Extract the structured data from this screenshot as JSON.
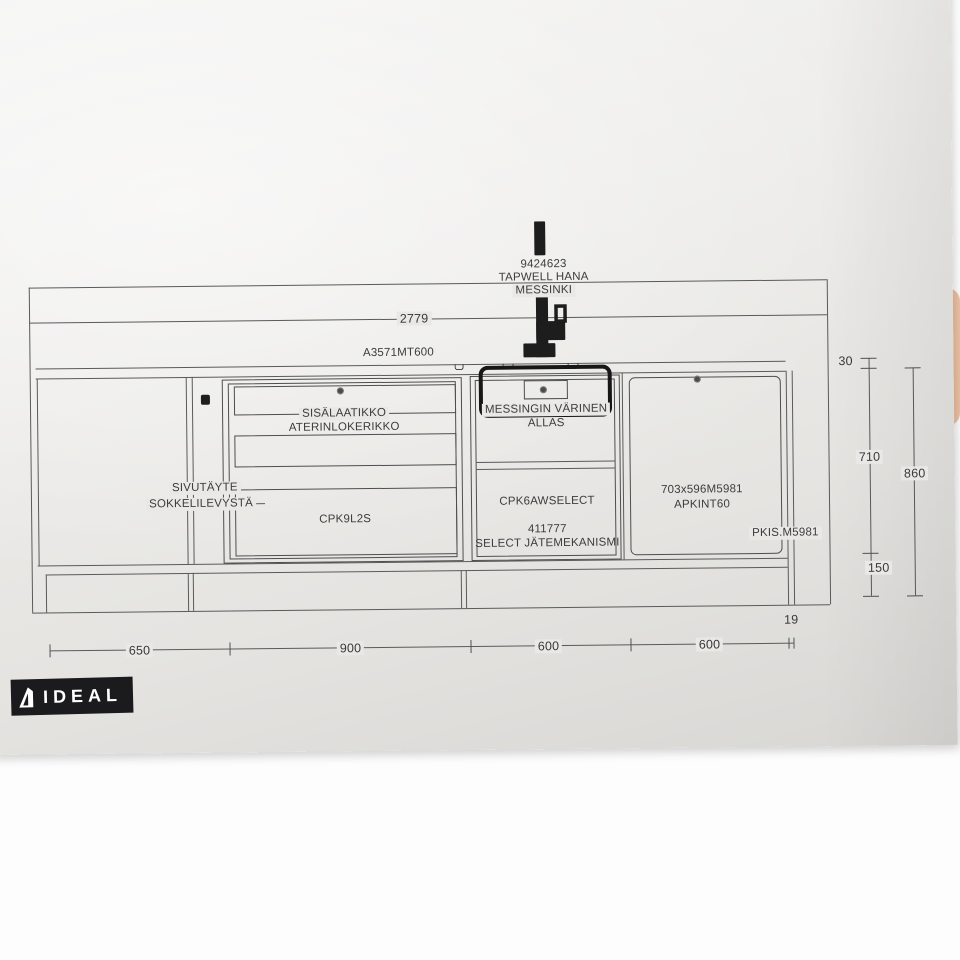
{
  "labels": {
    "faucet_code": "9424623",
    "faucet_name": "TAPWELL HANA",
    "faucet_material": "MESSINKI",
    "worktop_code": "A3571MT600",
    "sink_color_line1": "MESSINGIN VÄRINEN",
    "sink_color_line2": "ALLAS",
    "inner_drawer_line1": "SISÄLAATIKKO",
    "inner_drawer_line2": "ATERINLOKERIKKO",
    "filler_line1": "SIVUTÄYTE",
    "filler_line2": "SOKKELILEVYSTÄ",
    "drawer_cabinet_code": "CPK9L2S",
    "sink_cabinet_code": "CPK6AWSELECT",
    "waste_mech_code": "411777",
    "waste_mech_name": "SELECT JÄTEMEKANISMI",
    "appliance_size": "703x596M5981",
    "appliance_code": "APKINT60",
    "side_panel_code": "PKIS.M5981"
  },
  "dimensions": {
    "total_width": "2779",
    "bottom": [
      "650",
      "900",
      "600",
      "600"
    ],
    "end_gap": "19",
    "worktop_thickness": "30",
    "cabinet_height": "710",
    "total_height": "860",
    "plinth_height": "150"
  },
  "logo": {
    "brand": "IDEAL"
  },
  "icons": {
    "faucet": "faucet-icon",
    "screw": "screw-icon",
    "knob": "knob-icon",
    "sink_clip": "clip-icon",
    "logo_mark": "ideal-logo-icon"
  },
  "colors": {
    "paper": "#e9e8e6",
    "line": "#5a5a5a",
    "ink": "#3c3c3c",
    "faucet_black": "#1d1d1d",
    "logo_bg": "#1b1b1d",
    "logo_text": "#ffffff",
    "hand_skin": "#edc2a4"
  }
}
